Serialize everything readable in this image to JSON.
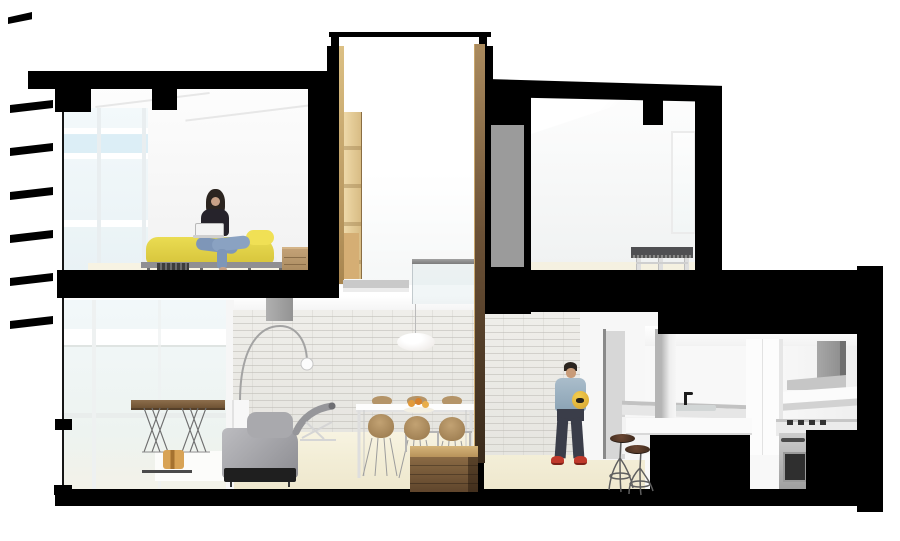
{
  "type": "architectural-section-rendering",
  "title": "Two-storey apartment cutaway section",
  "palette": {
    "cut_poche_black": "#000000",
    "background_white": "#ffffff",
    "duvet_yellow": "#e3d34a",
    "duvet_fold_yellow": "#f0e055",
    "jeans_blue": "#7e96b8",
    "denim_jacket_blue": "#9db4c6",
    "ball_yellow": "#e9c043",
    "sneaker_red": "#c0392b",
    "stool_seat_brown": "#5d3d2a",
    "ladder_wood_tan": "#e6cf9d",
    "stair_wood_brown": "#7a5c3b",
    "dining_chair_tan": "#b0905f",
    "door_panel_gray": "#9b9b9b",
    "brick_wall_offwhite": "#ecebe7",
    "floor_beige": "#f3eed8",
    "glass_blue": "#d8ecf4",
    "frame_gray": "#8f8f92",
    "appliance_steel": "#b5b5b5"
  },
  "scene": {
    "description": "Black-and-white sectional perspective through a two-storey apartment with a central double-height light well; furnishings rendered in colour.",
    "levels": [
      {
        "name": "upper",
        "rooms": [
          "bedroom",
          "light-well",
          "second-bedroom"
        ]
      },
      {
        "name": "lower",
        "rooms": [
          "living-room",
          "dining-area",
          "hallway",
          "kitchen"
        ]
      }
    ],
    "people": [
      {
        "id": "woman-on-bed",
        "location": "bedroom",
        "pose": "sitting cross-legged on bed using a white laptop",
        "hair": "long dark",
        "top": "black",
        "pants": "blue jeans",
        "feet": "bare"
      },
      {
        "id": "man-in-hallway",
        "location": "hallway",
        "pose": "standing, holding yellow football helmet",
        "jacket": "light denim",
        "pants": "dark navy",
        "shoes": "red sneakers"
      }
    ],
    "bedroom": {
      "furniture": [
        "bed with yellow duvet",
        "gray bed frame",
        "slatted dark bench at foot",
        "wood nightstand with drawers"
      ],
      "window": "full-height mullioned glazing on left facade"
    },
    "light_well": {
      "features": [
        "rooftop skylight monitor",
        "timber ladder on left wall",
        "timber-clad cut edges",
        "gray handrail and glass balustrade",
        "gray landing"
      ]
    },
    "second_bedroom": {
      "furniture": [
        "dark gray daybed bench on white legs"
      ],
      "features": [
        "window on right wall",
        "gray sliding door panel at left"
      ]
    },
    "living_room": {
      "furniture": [
        "walnut desk with wire trestle legs",
        "white rug",
        "small timber stool",
        "gray sofa with black base",
        "gray chaise longue",
        "arc floor lamp with white shade"
      ],
      "walls": [
        "glazed facade left",
        "white painted brick feature wall"
      ]
    },
    "dining_area": {
      "furniture": [
        "white dining table",
        "five tan molded chairs",
        "metal-and-glass bench",
        "white saucer pendant lamp",
        "fruit bowl"
      ],
      "features": [
        "timber stair box at cut plane"
      ]
    },
    "hallway": {
      "features": [
        "white brick wall",
        "recessed door with gray panel",
        "two industrial bar stools with brown seats"
      ]
    },
    "kitchen": {
      "features": [
        "L-shaped white counters",
        "island with white counter",
        "sink with black faucet",
        "stainless wall oven",
        "black cooktop",
        "gray extract hood",
        "white shelf ledge",
        "tall white cabinet"
      ]
    },
    "structure": {
      "cut_elements": [
        "roof slab with downstand beams",
        "floor slabs",
        "party walls",
        "base slab",
        "facade louvre fins",
        "island and cabinet cuts"
      ],
      "louvre_fin_count": 7
    }
  }
}
